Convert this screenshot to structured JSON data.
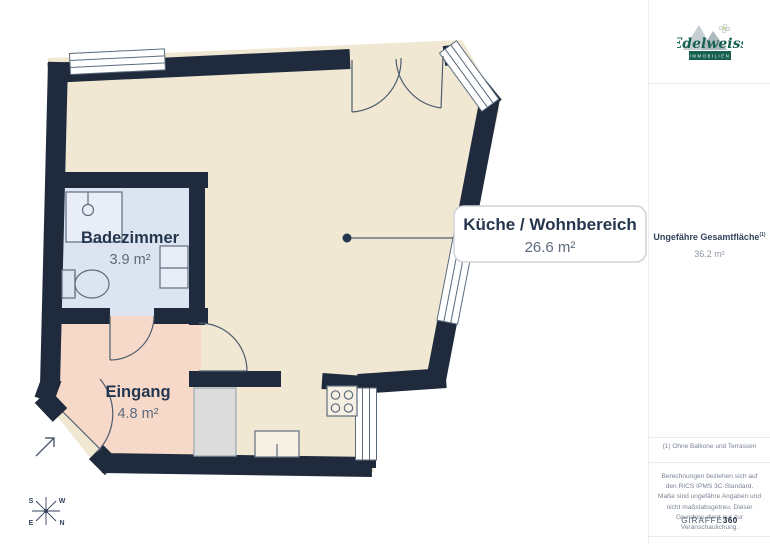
{
  "floor_plan": {
    "rooms": [
      {
        "name": "Badezimmer",
        "area": "3.9 m²"
      },
      {
        "name": "Eingang",
        "area": "4.8 m²"
      },
      {
        "name": "Küche / Wohnbereich",
        "area": "26.6 m²"
      }
    ],
    "compass": {
      "top_left": "S",
      "top_right": "W",
      "bottom_left": "E",
      "bottom_right": "N"
    },
    "colors": {
      "wall": "#1f2b3d",
      "living_room_fill": "#f1e8d3",
      "bathroom_fill": "#dde4f1",
      "entrance_fill": "#f7d9ca",
      "label_text": "#25374e",
      "area_text": "#5d6b7c"
    }
  },
  "sidebar": {
    "logo": {
      "brand": "Edelweiss",
      "tagline": "IMMOBILIEN"
    },
    "total_area": {
      "label": "Ungefähre Gesamtfläche",
      "footnote_marker": "(1)",
      "value": "36.2 m²"
    },
    "footnote": "(1) Ohne Balkone und Terrassen",
    "disclaimer": "Berechnungen beziehen sich auf den RICS IPMS 3C-Standard. Maße sind ungefähre Angaben und nicht maßstabsgetreu. Dieser Grundriss dient nur zur Veranschaulichung.",
    "credit_brand": "GIRAFFE",
    "credit_bold": "360"
  }
}
